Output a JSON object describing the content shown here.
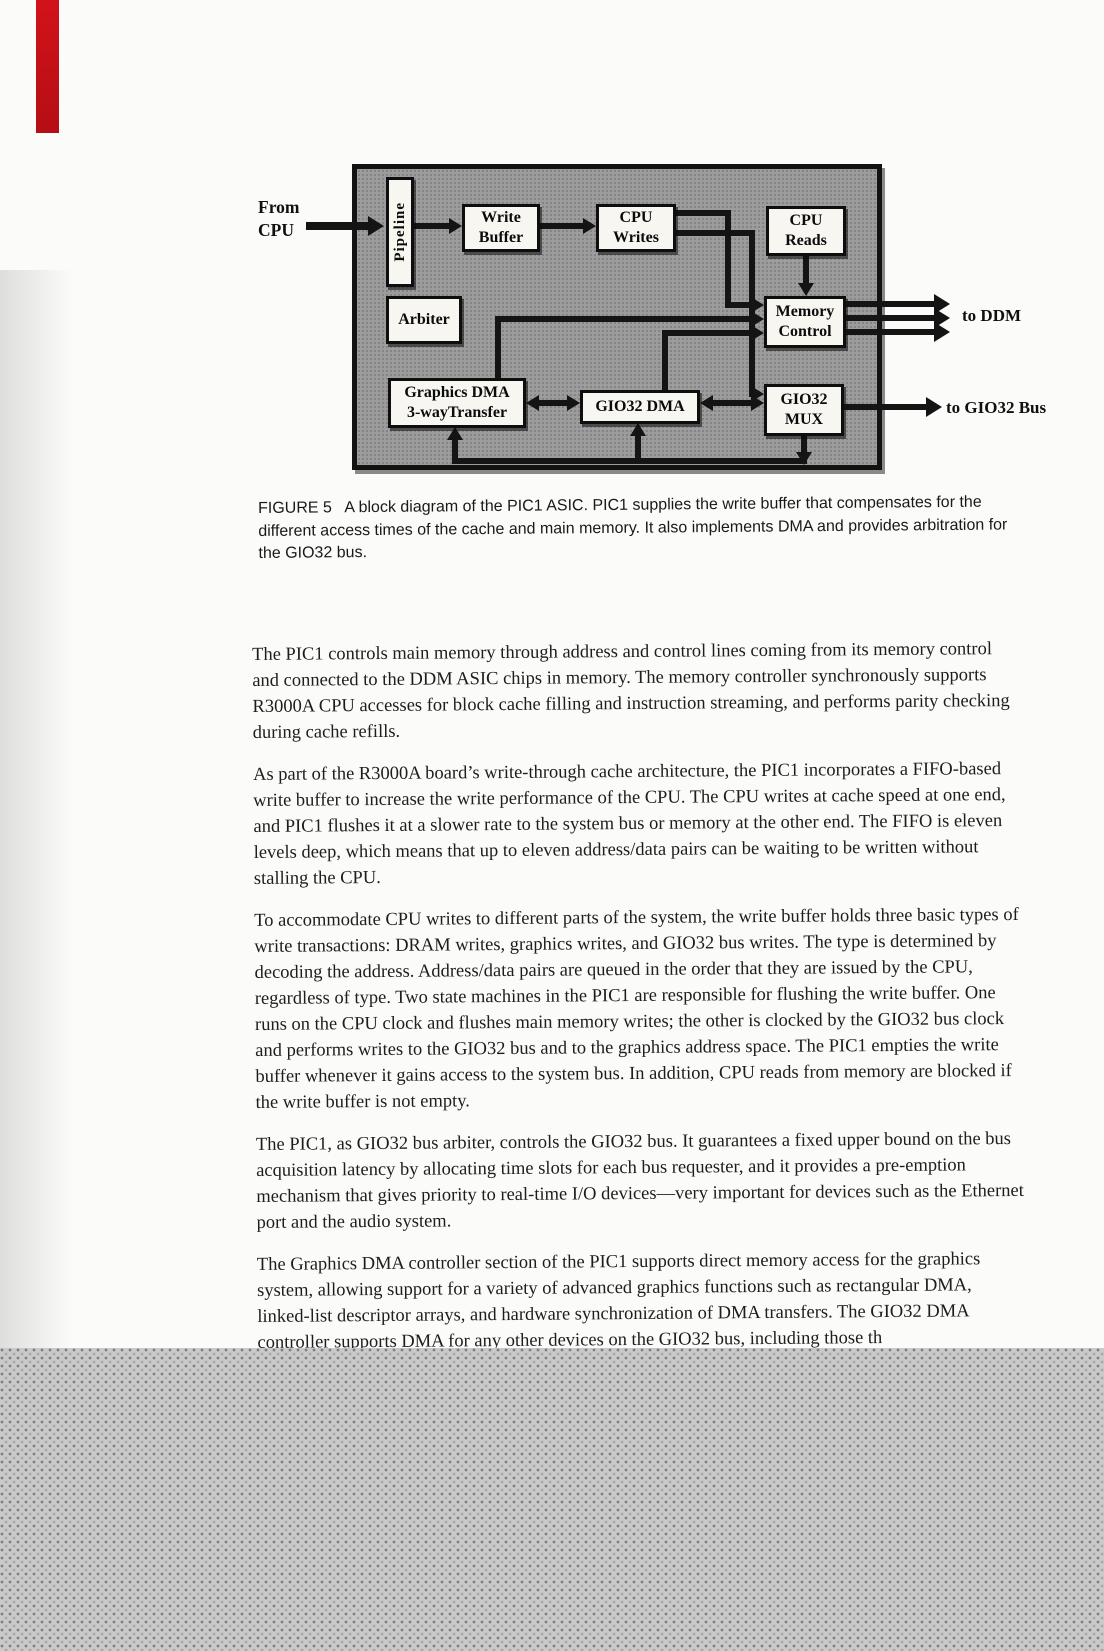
{
  "colors": {
    "bookmark_red": "#c90f16",
    "diagram_gray": "#9d9d9d",
    "halftone_gray": "#c9c9c9"
  },
  "diagram": {
    "from_label": [
      "From",
      "CPU"
    ],
    "to_ddm_label": "to DDM",
    "to_gio32_label": "to GIO32 Bus",
    "boxes": {
      "pipeline": "Pipeline",
      "write_buffer": [
        "Write",
        "Buffer"
      ],
      "cpu_writes": [
        "CPU",
        "Writes"
      ],
      "cpu_reads": [
        "CPU",
        "Reads"
      ],
      "arbiter": "Arbiter",
      "memory_control": [
        "Memory",
        "Control"
      ],
      "graphics_dma": [
        "Graphics DMA",
        "3-wayTransfer"
      ],
      "gio32_dma": "GIO32 DMA",
      "gio32_mux": [
        "GIO32",
        "MUX"
      ]
    }
  },
  "caption": {
    "text": "FIGURE 5   A block diagram of the PIC1 ASIC. PIC1 supplies the write buffer that compensates for the different access times of the cache and main memory. It also implements DMA and provides arbitration for the GIO32 bus."
  },
  "body": {
    "paragraphs": [
      "The PIC1 controls main memory through address and control lines coming from its memory control and connected to the DDM ASIC chips in memory. The memory controller synchronously supports R3000A CPU accesses for block cache filling and instruction streaming, and performs parity checking during cache refills.",
      "As part of the R3000A board’s write-through cache architecture, the PIC1 incorporates a FIFO-based write buffer to increase the write performance of the CPU. The CPU writes at cache speed at one end, and PIC1 flushes it at a slower rate to the system bus or memory at the other end. The FIFO is eleven levels deep, which means that up to eleven address/data pairs can be waiting to be written without stalling the CPU.",
      "To accommodate CPU writes to different parts of the system, the write buffer holds three basic types of write transactions: DRAM writes, graphics writes, and GIO32 bus writes. The type is determined by decoding the address. Address/data pairs are queued in the order that they are issued by the CPU, regardless of type. Two state machines in the PIC1 are responsible for flushing the write buffer. One runs on the CPU clock and flushes main memory writes; the other is clocked by the GIO32 bus clock and performs writes to the GIO32 bus and to the graphics address space. The PIC1 empties the write buffer whenever it gains access to the system bus. In addition, CPU reads from memory are blocked if the write buffer is not empty.",
      "The PIC1, as GIO32 bus arbiter, controls the GIO32 bus. It guarantees a fixed upper bound on the bus acquisition latency by allocating time slots for each bus requester, and it provides a pre-emption mechanism that gives priority to real-time I/O devices—very important for devices such as the Ethernet port and the audio system.",
      "The Graphics DMA controller section of the PIC1 supports direct memory access for the graphics system, allowing support for a variety of advanced graphics functions such as rectangular DMA, linked-list descriptor arrays, and hardware synchronization of DMA transfers. The GIO32 DMA controller supports DMA for any other devices on the GIO32 bus, including those th"
    ]
  }
}
